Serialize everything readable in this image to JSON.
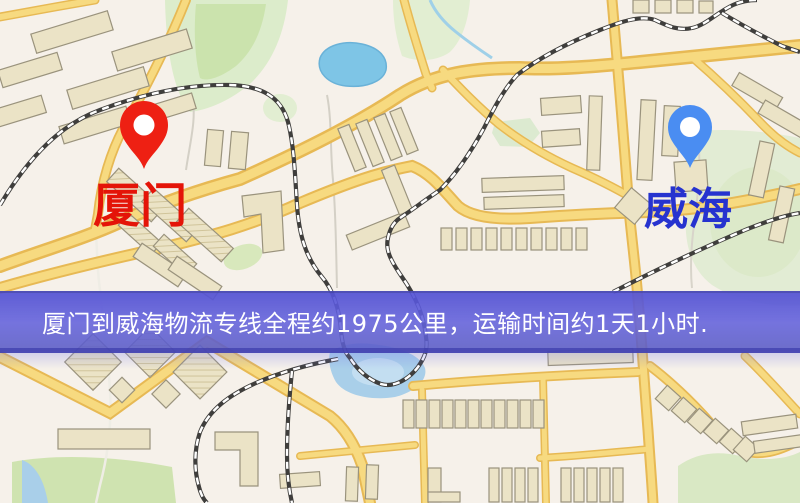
{
  "map": {
    "banner": {
      "text": "厦门到威海物流专线全程约1975公里，运输时间约1天1小时.",
      "bg_color": "#5956d4",
      "text_color": "#ffffff"
    },
    "origin": {
      "label": "厦门",
      "pin_color": "#ee2013",
      "label_color": "#e41408"
    },
    "destination": {
      "label": "威海",
      "pin_color": "#4a8df2",
      "label_color": "#2633cf"
    },
    "palette": {
      "background": "#f6f1ea",
      "road_fill": "#f7da80",
      "road_border": "#e7b954",
      "railway": "#3f3e3c",
      "building": "#ebe3c6",
      "park": "#dceccb",
      "water_lake": "#7ec5e6",
      "water_river": "#a9cfe9"
    }
  }
}
